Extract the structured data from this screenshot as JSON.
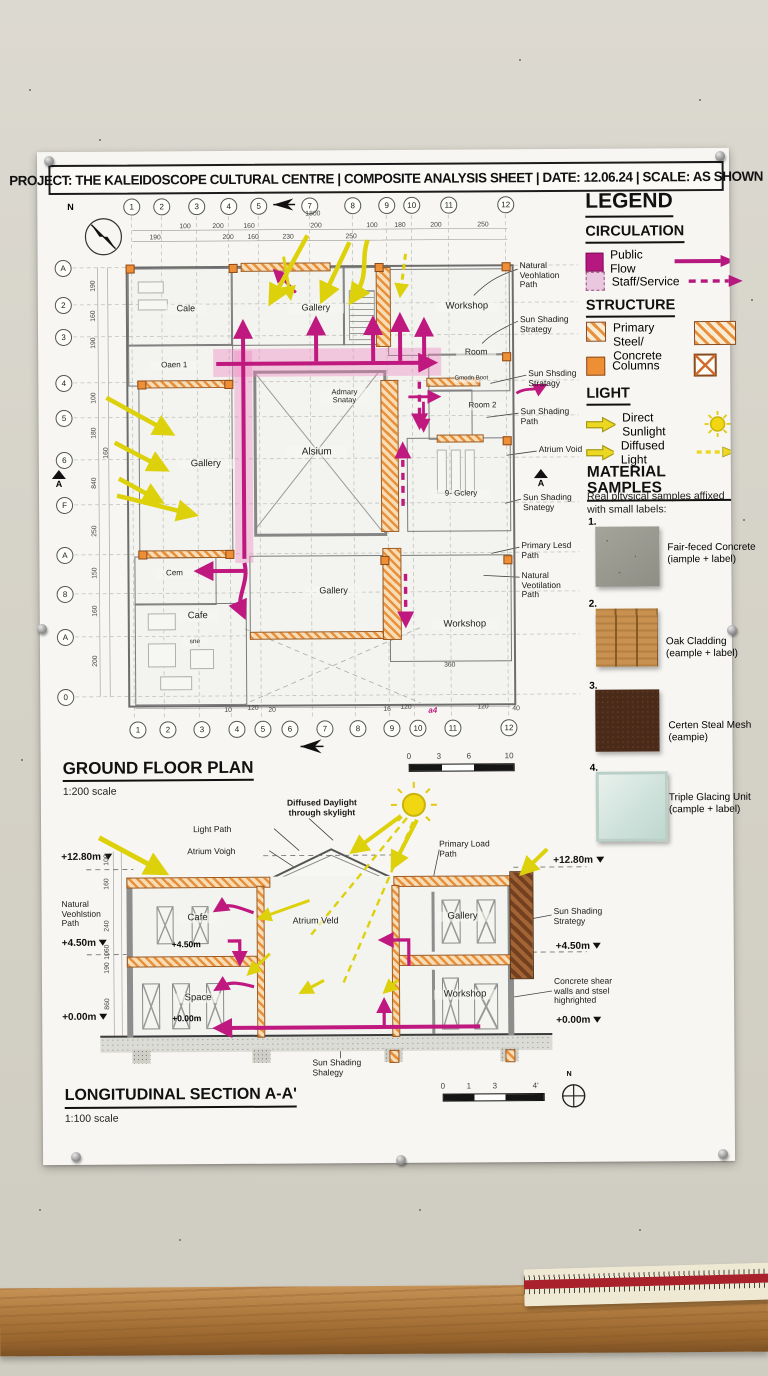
{
  "title_bar": {
    "text": "PROJECT: THE KALEIDOSCOPE CULTURAL CENTRE | COMPOSITE ANALYSIS SHEET | DATE: 12.06.24 | SCALE: AS SHOWN"
  },
  "colors": {
    "public_flow": "#b5187e",
    "staff_service": "#e9c7df",
    "structure_orange": "#ee8f35",
    "light_yellow": "#e6da12"
  },
  "legend": {
    "title": "LEGEND",
    "circulation": {
      "title": "CIRCULATION",
      "public_flow": "Public Flow",
      "staff_service": "Staff/Service"
    },
    "structure": {
      "title": "STRUCTURE",
      "primary": "Primary Steel/ Concrete",
      "columns": "Columns"
    },
    "light": {
      "title": "LIGHT",
      "direct": "Direct Sunlight",
      "diffused": "Diffused Light"
    }
  },
  "materials": {
    "title": "MATERIAL SAMPLES",
    "subtitle": "Real pltysical samples affixed with small labels:",
    "items": [
      {
        "num": "1.",
        "label": "Fair-feced Concrete (iample + label)"
      },
      {
        "num": "2.",
        "label": "Oak Cladding (eample + label)"
      },
      {
        "num": "3.",
        "label": "Certen Steal Mesh (eampie)"
      },
      {
        "num": "4.",
        "label": "Triple Glacing Unit (cample + label)"
      }
    ]
  },
  "plan": {
    "title": "GROUND FLOOR PLAN",
    "scale_label": "1:200 scale",
    "north": "N",
    "section_marker": "A",
    "grid_top": [
      "1",
      "2",
      "3",
      "4",
      "5",
      "7",
      "8",
      "9",
      "10",
      "11",
      "12"
    ],
    "grid_bottom": [
      "1",
      "2",
      "3",
      "4",
      "5",
      "6",
      "7",
      "8",
      "9",
      "10",
      "11",
      "12"
    ],
    "grid_left": [
      "A",
      "2",
      "3",
      "4",
      "5",
      "6",
      "F",
      "A",
      "8",
      "A",
      "0"
    ],
    "rooms": {
      "cafe_top": "Cale",
      "gallery_top": "Gallery",
      "workshop_top": "Workshop",
      "room1": "Oaen 1",
      "room": "Room",
      "strategy": "Admary Snatay",
      "room2": "Room 2",
      "annex": "Gmodn Boot",
      "atrium": "Alsium",
      "gallery_left": "Gallery",
      "gallery_right": "9- Gclery",
      "cem": "Cem",
      "cafe": "Cafe",
      "sne": "sne",
      "gallery_bottom": "Gallery",
      "workshop_bottom": "Workshop"
    },
    "callouts": [
      "Natural Veohlation Path",
      "Sun Shading Strategy",
      "Sun Shsding Stratagy",
      "Sun Shading Path",
      "Atrium Void",
      "Sun Shading Snategy",
      "Primary Lesd Path",
      "Natural Veotilation Path"
    ],
    "dim_overall": "1800",
    "dims_top": [
      "100",
      "200",
      "160",
      "200",
      "100",
      "180",
      "200",
      "250"
    ],
    "dims_top2": [
      "190",
      "200",
      "160",
      "230",
      "250"
    ],
    "dims_left": [
      "190",
      "160",
      "190",
      "100",
      "180",
      "160",
      "840",
      "250",
      "150",
      "160",
      "200"
    ],
    "dims_bottom": [
      "10",
      "120",
      "20",
      "16",
      "120",
      "120",
      "40"
    ],
    "dim_inner": "360",
    "dim_marker": "a4",
    "scalebar": [
      "0",
      "3",
      "6",
      "10"
    ]
  },
  "section": {
    "title": "LONGITUDINAL SECTION A-A'",
    "scale_label": "1:100 scale",
    "north": "N",
    "labels_left": [
      "+12.80m",
      "Natural Veohlstion Path",
      "+4.50m",
      "+0.00m"
    ],
    "labels_right": [
      "+12.80m",
      "Sun Shading Strategy",
      "+4.50m",
      "Concrete shear walls and stsel highrighted",
      "+0.00m"
    ],
    "label_daylight": "Diffused Daylight through skylight",
    "label_lightpath": "Light Path",
    "label_atrium_void": "Atrium Voigh",
    "label_load_path": "Primary Load Path",
    "rooms": {
      "cafe": "Cafe",
      "atrium": "Atrium Veld",
      "gallery": "Gallery",
      "space": "Space",
      "workshop": "Workshop"
    },
    "inner_levels": {
      "l1": "+4.50m",
      "l2": "+0.00m"
    },
    "bottom_callout": "Sun Shading Shalegy",
    "dims": [
      "100",
      "160",
      "240",
      "1060",
      "190",
      "860"
    ],
    "scalebar": [
      "0",
      "1",
      "3",
      "4'"
    ]
  }
}
